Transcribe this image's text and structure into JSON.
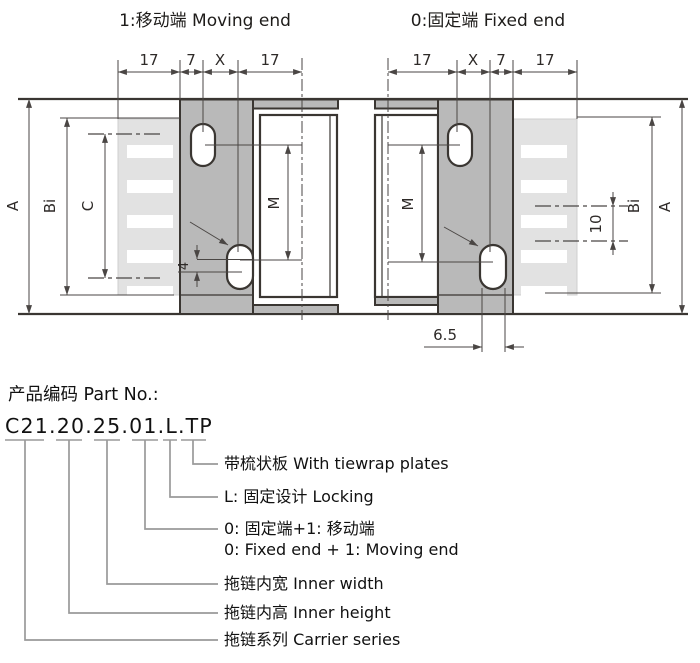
{
  "titles": {
    "left": "1:移动端 Moving end",
    "right": "0:固定端 Fixed end"
  },
  "left_view": {
    "dims_top": [
      "17",
      "7",
      "X",
      "17"
    ],
    "labels": {
      "A": "A",
      "Bi": "Bi",
      "C": "C",
      "M": "M",
      "hole_offset": "4"
    }
  },
  "right_view": {
    "dims_top": [
      "17",
      "X",
      "7",
      "17"
    ],
    "labels": {
      "M": "M",
      "pitch": "10",
      "Bi": "Bi",
      "A": "A",
      "slot_offset": "6.5"
    }
  },
  "part": {
    "heading": "产品编码 Part No.:",
    "number": "C21.20.25.01.L.TP",
    "breakdown": [
      {
        "label": "带梳状板 With tiewrap plates"
      },
      {
        "label": "L: 固定设计 Locking"
      },
      {
        "label": "0: 固定端+1: 移动端",
        "label2": "0: Fixed end + 1: Moving end"
      },
      {
        "label": "拖链内宽 Inner width"
      },
      {
        "label": "拖链内高 Inner height"
      },
      {
        "label": "拖链系列 Carrier series"
      }
    ]
  },
  "colors": {
    "plate_gray": "#b9b9b9",
    "comb_gray": "#e2e2e2",
    "outline": "#3a3632",
    "dimension": "#4a4644",
    "tree_gray": "#9a9a9a"
  }
}
